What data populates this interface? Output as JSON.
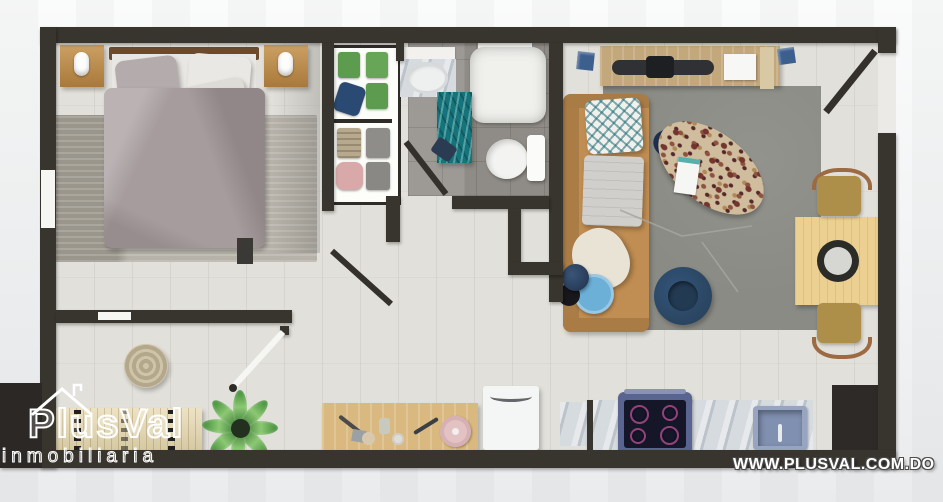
{
  "meta": {
    "type": "apartment-floorplan-render",
    "view": "top-down 3D"
  },
  "branding": {
    "logo_text": "PlusVal",
    "logo_subtext": "inmobiliaria",
    "website": "WWW.PLUSVAL.COM.DO",
    "logo_house_icon": "roof-with-chimney-outline"
  },
  "palette": {
    "wall": "#38342e",
    "floor": "#e2e0da",
    "bathfloor": "#8f8b86",
    "bedrug": "#b6b2a9",
    "liverug": "#8b8b85",
    "duvet": "#a69c9e",
    "wood": "#c08a42",
    "sofa": "#c08d52",
    "console": "#c3a87c",
    "dtable": "#ecd092",
    "chair": "#ad8f4a",
    "navy": "#2a4560",
    "bluetable": "#6cb0d8",
    "tealrug": "#15737b",
    "terrazzo": "#d0bd9e",
    "marble": "#c9cfd4",
    "stove": "#5a6491",
    "stovetop": "#151729",
    "sink": "#8090b0",
    "island": "#d9b97f",
    "fridge": "#f4f6f6",
    "plant": "#4e9a41",
    "bench": "#e7d9b0",
    "logobg": "#2b2825",
    "background": "#f2f3f4"
  },
  "rooms": [
    {
      "name": "bedroom",
      "furniture": [
        "double-bed",
        "headboard",
        "pillows",
        "gray-duvet",
        "nightstand-left",
        "nightstand-right",
        "table-lamps",
        "area-rug",
        "closet-shelves-with-clothes"
      ]
    },
    {
      "name": "bathroom",
      "furniture": [
        "vanity-sink",
        "walk-in-shower",
        "toilet",
        "teal-rug",
        "towel"
      ]
    },
    {
      "name": "living-room",
      "furniture": [
        "tv-console",
        "flat-tv",
        "wall-art",
        "sofa-with-pillows",
        "terrazzo-coffee-table",
        "navy-armchair",
        "blue-side-table",
        "table-lamp",
        "gray-area-rug"
      ]
    },
    {
      "name": "dining-area",
      "furniture": [
        "square-wood-table",
        "round-tray",
        "chair-north",
        "chair-south",
        "entry-door"
      ]
    },
    {
      "name": "kitchen",
      "furniture": [
        "marble-counter",
        "stove-4-burners",
        "blue-sink",
        "refrigerator",
        "tall-dark-cabinet",
        "wood-island-with-utensils",
        "pink-plate"
      ]
    },
    {
      "name": "hallway",
      "furniture": [
        "woven-pouf",
        "potted-plant",
        "slatted-bench",
        "white-interior-door"
      ]
    }
  ]
}
